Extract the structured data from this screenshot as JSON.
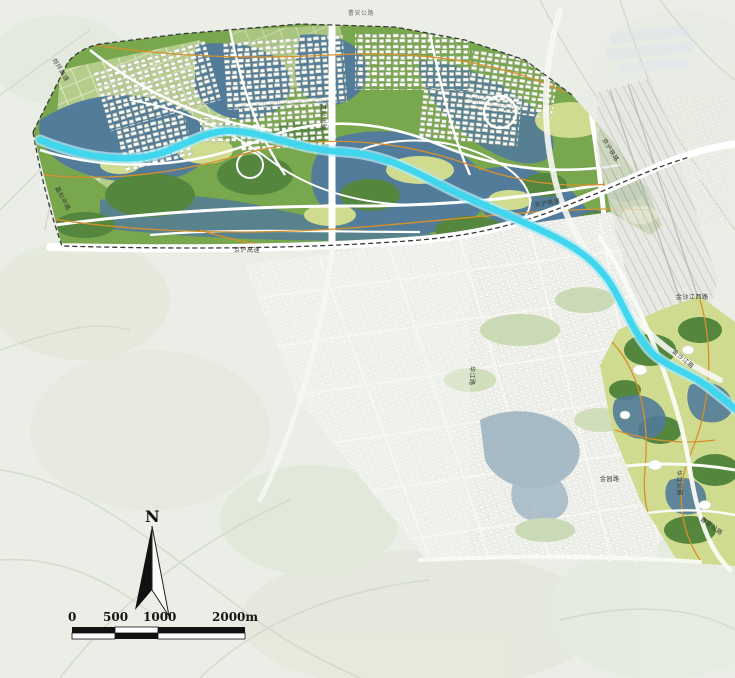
{
  "map": {
    "north_label": "N",
    "scale_bar": {
      "tick_labels": [
        "0",
        "500",
        "1000",
        "2000m"
      ]
    },
    "road_labels": [
      {
        "text": "曹安公路"
      },
      {
        "text": "郊环高速"
      },
      {
        "text": "嘉松中路"
      },
      {
        "text": "嘉松北路"
      },
      {
        "text": "京沪高速"
      },
      {
        "text": "京沪高速"
      },
      {
        "text": "京沪铁路"
      },
      {
        "text": "金沙江西路"
      },
      {
        "text": "金沙江路"
      },
      {
        "text": "华江路"
      },
      {
        "text": "金园路"
      },
      {
        "text": "华江公路"
      },
      {
        "text": "曹安公路"
      }
    ],
    "colors": {
      "background": "#ebeee7",
      "river": "#3fd6ee",
      "river_glow": "#aeeaf6",
      "water": "#527c99",
      "park_green": "#79a74e",
      "park_dark": "#55863e",
      "meadow": "#cfdc8f",
      "road_orange": "#d8902c",
      "boundary": "#3a3a3a"
    }
  }
}
